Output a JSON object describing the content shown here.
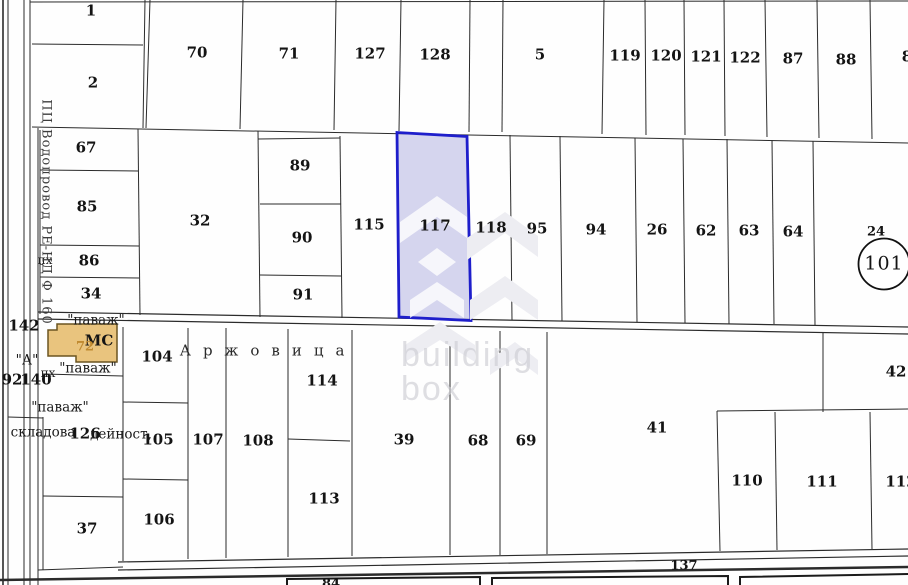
{
  "title": "Cadastral parcel map with highlighted plot 117",
  "colors": {
    "highlight_stroke": "#1e1ecb",
    "highlight_fill": "rgba(130,130,205,0.33)",
    "building_fill": "#e9c47e",
    "building_stroke": "#6b5520",
    "line": "#2b2b2b",
    "watermark": "#e3e3e8"
  },
  "watermark": {
    "line1": "building",
    "line2": "box"
  },
  "street_label": "Аржовица",
  "utility_label": "ПЦ Водопровод РЕ-НД Ф 160",
  "highlighted_parcel": "117",
  "labels": [
    {
      "name": "parcel-1-label",
      "text": "1",
      "x": 91,
      "y": 11,
      "cls": "num"
    },
    {
      "name": "parcel-2-label",
      "text": "2",
      "x": 93,
      "y": 83,
      "cls": "num"
    },
    {
      "name": "parcel-70-label",
      "text": "70",
      "x": 197,
      "y": 53,
      "cls": "num"
    },
    {
      "name": "parcel-71-label",
      "text": "71",
      "x": 289,
      "y": 54,
      "cls": "num"
    },
    {
      "name": "parcel-127-label",
      "text": "127",
      "x": 370,
      "y": 54,
      "cls": "num"
    },
    {
      "name": "parcel-128-label",
      "text": "128",
      "x": 435,
      "y": 55,
      "cls": "num"
    },
    {
      "name": "parcel-5-label",
      "text": "5",
      "x": 540,
      "y": 55,
      "cls": "num"
    },
    {
      "name": "parcel-119-label",
      "text": "119",
      "x": 625,
      "y": 56,
      "cls": "num"
    },
    {
      "name": "parcel-120-label",
      "text": "120",
      "x": 666,
      "y": 56,
      "cls": "num"
    },
    {
      "name": "parcel-121-label",
      "text": "121",
      "x": 706,
      "y": 57,
      "cls": "num"
    },
    {
      "name": "parcel-122-label",
      "text": "122",
      "x": 745,
      "y": 58,
      "cls": "num"
    },
    {
      "name": "parcel-87-label",
      "text": "87",
      "x": 793,
      "y": 59,
      "cls": "num"
    },
    {
      "name": "parcel-88-label",
      "text": "88",
      "x": 846,
      "y": 60,
      "cls": "num"
    },
    {
      "name": "parcel-partial-right-label",
      "text": "8",
      "x": 907,
      "y": 57,
      "cls": "num"
    },
    {
      "name": "parcel-67-label",
      "text": "67",
      "x": 86,
      "y": 148,
      "cls": "num"
    },
    {
      "name": "parcel-85-label",
      "text": "85",
      "x": 87,
      "y": 207,
      "cls": "num"
    },
    {
      "name": "px-upper-label",
      "text": "пх",
      "x": 45,
      "y": 260,
      "cls": "small"
    },
    {
      "name": "parcel-86-label",
      "text": "86",
      "x": 89,
      "y": 261,
      "cls": "num"
    },
    {
      "name": "parcel-34-label",
      "text": "34",
      "x": 91,
      "y": 294,
      "cls": "num"
    },
    {
      "name": "parcel-32-label",
      "text": "32",
      "x": 200,
      "y": 221,
      "cls": "num"
    },
    {
      "name": "parcel-89-label",
      "text": "89",
      "x": 300,
      "y": 166,
      "cls": "num"
    },
    {
      "name": "parcel-90-label",
      "text": "90",
      "x": 302,
      "y": 238,
      "cls": "num"
    },
    {
      "name": "parcel-91-label",
      "text": "91",
      "x": 303,
      "y": 295,
      "cls": "num"
    },
    {
      "name": "parcel-115-label",
      "text": "115",
      "x": 369,
      "y": 225,
      "cls": "num"
    },
    {
      "name": "parcel-117-label",
      "text": "117",
      "x": 435,
      "y": 226,
      "cls": "num"
    },
    {
      "name": "parcel-118-label",
      "text": "118",
      "x": 491,
      "y": 228,
      "cls": "num"
    },
    {
      "name": "parcel-95-label",
      "text": "95",
      "x": 537,
      "y": 229,
      "cls": "num"
    },
    {
      "name": "parcel-94-label",
      "text": "94",
      "x": 596,
      "y": 230,
      "cls": "num"
    },
    {
      "name": "parcel-26-label",
      "text": "26",
      "x": 657,
      "y": 230,
      "cls": "num"
    },
    {
      "name": "parcel-62-label",
      "text": "62",
      "x": 706,
      "y": 231,
      "cls": "num"
    },
    {
      "name": "parcel-63-label",
      "text": "63",
      "x": 749,
      "y": 231,
      "cls": "num"
    },
    {
      "name": "parcel-64-label",
      "text": "64",
      "x": 793,
      "y": 232,
      "cls": "num"
    },
    {
      "name": "parcel-24-label",
      "text": "24",
      "x": 876,
      "y": 232,
      "cls": "num-sm"
    },
    {
      "name": "parcel-101-label",
      "text": "101",
      "x": 884,
      "y": 264,
      "cls": "num-lg"
    },
    {
      "name": "parcel-142-label",
      "text": "142",
      "x": 24,
      "y": 326,
      "cls": "num"
    },
    {
      "name": "quoted-a-label",
      "text": "\"А\"",
      "x": 27,
      "y": 361,
      "cls": "note"
    },
    {
      "name": "px-lower-label",
      "text": "пх",
      "x": 48,
      "y": 373,
      "cls": "small"
    },
    {
      "name": "parcel-92-label",
      "text": "92",
      "x": 12,
      "y": 380,
      "cls": "num"
    },
    {
      "name": "parcel-140-label",
      "text": "140",
      "x": 36,
      "y": 380,
      "cls": "num"
    },
    {
      "name": "pavazh-top-label",
      "text": "\"паваж\"",
      "x": 96,
      "y": 321,
      "cls": "note"
    },
    {
      "name": "pavazh-mid-label",
      "text": "\"паваж\"",
      "x": 88,
      "y": 369,
      "cls": "note"
    },
    {
      "name": "pavazh-low-label",
      "text": "\"паваж\"",
      "x": 60,
      "y": 408,
      "cls": "note"
    },
    {
      "name": "skladova-label",
      "text": "складова",
      "x": 43,
      "y": 433,
      "cls": "note"
    },
    {
      "name": "parcel-126-label",
      "text": "126",
      "x": 85,
      "y": 434,
      "cls": "num"
    },
    {
      "name": "deynost-label",
      "text": "дейност,",
      "x": 121,
      "y": 435,
      "cls": "note"
    },
    {
      "name": "building-ms-label",
      "text": "МС",
      "x": 99,
      "y": 341,
      "cls": "mc"
    },
    {
      "name": "building-72-label",
      "text": "72",
      "x": 85,
      "y": 347,
      "cls": "b72"
    },
    {
      "name": "street-arzhovitsa-label",
      "text": "Аржовица",
      "x": 268,
      "y": 351,
      "cls": "street"
    },
    {
      "name": "vodoprovod-label",
      "text": "ПЦ Водопровод РЕ-НД Ф 160",
      "x": 46,
      "y": 212,
      "cls": "vtext"
    },
    {
      "name": "parcel-104-label",
      "text": "104",
      "x": 157,
      "y": 357,
      "cls": "num"
    },
    {
      "name": "parcel-105-label",
      "text": "105",
      "x": 158,
      "y": 440,
      "cls": "num"
    },
    {
      "name": "parcel-106-label",
      "text": "106",
      "x": 159,
      "y": 520,
      "cls": "num"
    },
    {
      "name": "parcel-37-label",
      "text": "37",
      "x": 87,
      "y": 529,
      "cls": "num"
    },
    {
      "name": "parcel-107-label",
      "text": "107",
      "x": 208,
      "y": 440,
      "cls": "num"
    },
    {
      "name": "parcel-108-label",
      "text": "108",
      "x": 258,
      "y": 441,
      "cls": "num"
    },
    {
      "name": "parcel-114-label",
      "text": "114",
      "x": 322,
      "y": 381,
      "cls": "num"
    },
    {
      "name": "parcel-113-label",
      "text": "113",
      "x": 324,
      "y": 499,
      "cls": "num"
    },
    {
      "name": "parcel-39-label",
      "text": "39",
      "x": 404,
      "y": 440,
      "cls": "num"
    },
    {
      "name": "parcel-68-label",
      "text": "68",
      "x": 478,
      "y": 441,
      "cls": "num"
    },
    {
      "name": "parcel-69-label",
      "text": "69",
      "x": 526,
      "y": 441,
      "cls": "num"
    },
    {
      "name": "parcel-41-label",
      "text": "41",
      "x": 657,
      "y": 428,
      "cls": "num"
    },
    {
      "name": "parcel-42-label",
      "text": "42",
      "x": 896,
      "y": 372,
      "cls": "num"
    },
    {
      "name": "parcel-110-label",
      "text": "110",
      "x": 747,
      "y": 481,
      "cls": "num"
    },
    {
      "name": "parcel-111-label",
      "text": "111",
      "x": 822,
      "y": 482,
      "cls": "num"
    },
    {
      "name": "parcel-112-partial-label",
      "text": "112",
      "x": 901,
      "y": 482,
      "cls": "num"
    },
    {
      "name": "road-137-label",
      "text": "137",
      "x": 684,
      "y": 566,
      "cls": "num-sm"
    },
    {
      "name": "road-84-partial-label",
      "text": "84",
      "x": 331,
      "y": 584,
      "cls": "num-sm"
    }
  ]
}
